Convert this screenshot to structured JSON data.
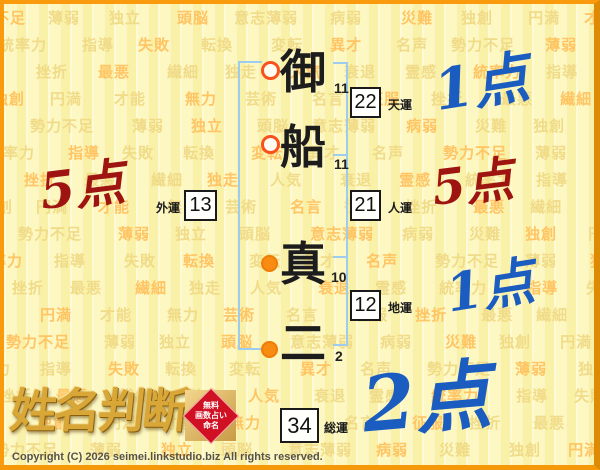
{
  "chart": {
    "characters": [
      {
        "char": "御",
        "strokes": "11",
        "part": "surname"
      },
      {
        "char": "船",
        "strokes": "11",
        "part": "surname"
      },
      {
        "char": "真",
        "strokes": "10",
        "part": "given"
      },
      {
        "char": "二",
        "strokes": "2",
        "part": "given"
      }
    ],
    "fortunes": {
      "ten": {
        "label": "天運",
        "value": "22",
        "score": "1点",
        "score_color": "blue"
      },
      "jin": {
        "label": "人運",
        "value": "21",
        "score": "5点",
        "score_color": "red"
      },
      "chi": {
        "label": "地運",
        "value": "12",
        "score": "1点",
        "score_color": "blue"
      },
      "gai": {
        "label": "外運",
        "value": "13",
        "score": "5点",
        "score_color": "red"
      },
      "sou": {
        "label": "総運",
        "value": "34",
        "score": "2点",
        "score_color": "blue"
      }
    }
  },
  "logo": {
    "title": "姓名判断",
    "seal_lines": [
      "無料",
      "画数占い",
      "命名"
    ]
  },
  "footer": {
    "copyright": "Copyright (C) 2026 seimei.linkstudio.biz All rights reserved."
  },
  "watermark": {
    "words": [
      "勢力不足",
      "衰退",
      "無力",
      "薄弱",
      "霊感",
      "芸術",
      "独立",
      "統率力",
      "名言",
      "頭脳",
      "指導",
      "征服",
      "意志薄弱",
      "失敗",
      "挫折",
      "病弱",
      "転換",
      "最悪",
      "災難",
      "変転",
      "繊細",
      "独創",
      "異才",
      "独走",
      "円満",
      "名声",
      "人気",
      "才能"
    ]
  },
  "colors": {
    "blue": "#1a5cc0",
    "red": "#9e1410",
    "bracket_blue": "#9dcdee",
    "frame_orange": "#f99b0c",
    "background_yellow": "#fdf8c2",
    "watermark_faint": "#f0db88",
    "watermark_strong": "#ffc463",
    "marker_hollow_ring": "#f9511d",
    "marker_filled": "#f88b11",
    "seal_red": "#d01023",
    "logo_gold": "#d8a738"
  }
}
